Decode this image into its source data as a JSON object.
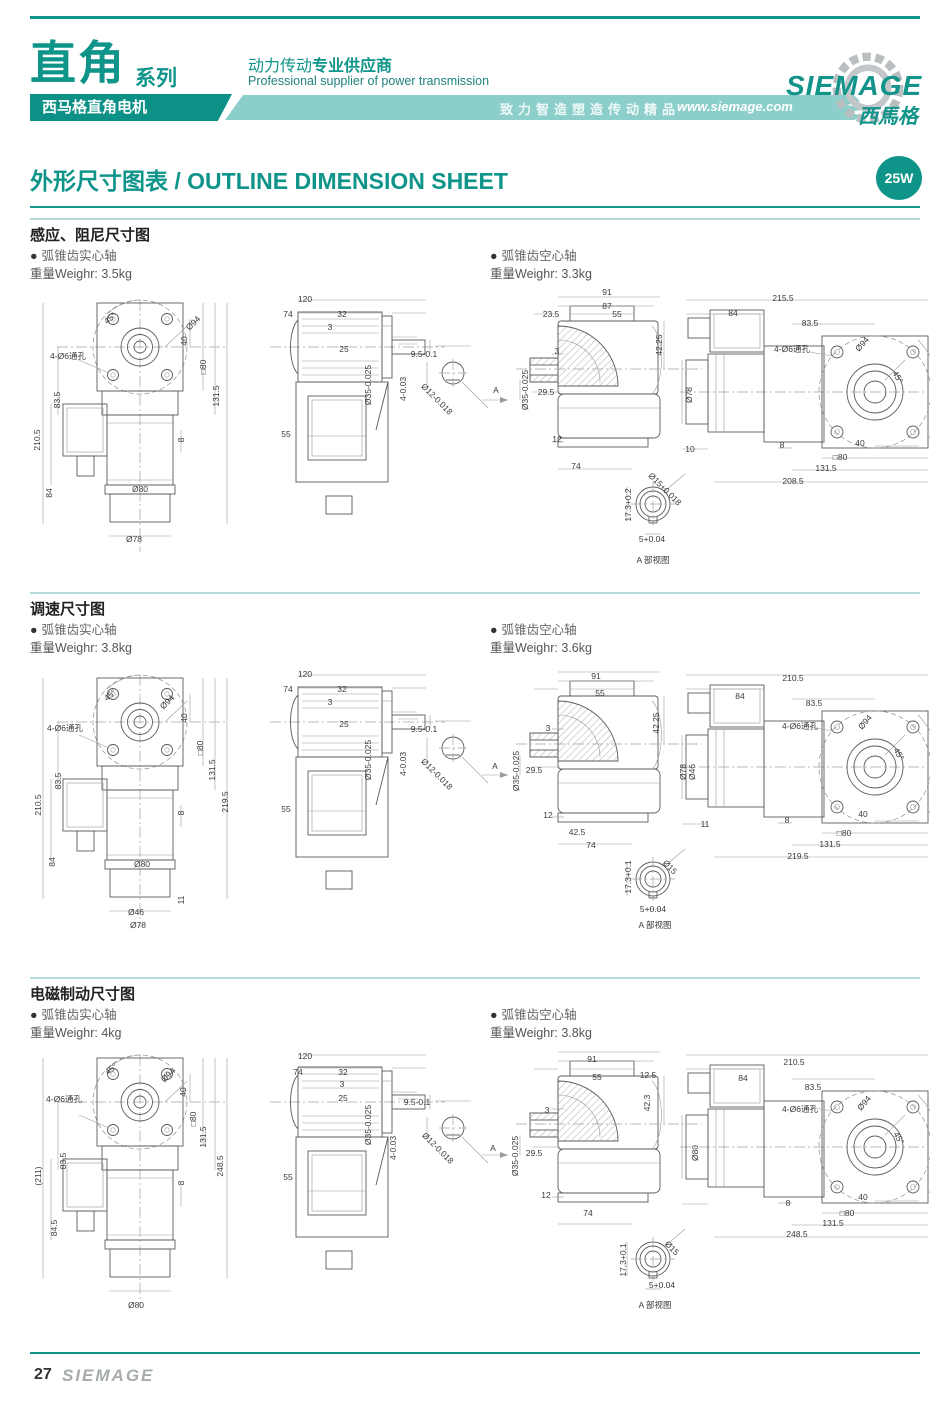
{
  "header": {
    "series_title": "直角",
    "series_suffix": "系列",
    "subtitle_box": "西马格直角电机",
    "slogan_cn_regular": "动力传动",
    "slogan_cn_bold": "专业供应商",
    "slogan_en": "Professional supplier of power transmission",
    "banner_text": "致力智造塑造传动精品",
    "website": "www.siemage.com",
    "logo_text": "SIEMAGE",
    "logo_cn": "西馬格",
    "accent_color": "#0f948a",
    "band_color": "#8ccfca"
  },
  "page_title": {
    "text": "外形尺寸图表 / OUTLINE DIMENSION SHEET",
    "badge": "25W"
  },
  "footer": {
    "page_number": "27",
    "logo": "SIEMAGE"
  },
  "sections": [
    {
      "title": "感应、阻尼尺寸图",
      "left_bullet": "弧锥齿实心轴",
      "left_weight": "重量Weighr: 3.5kg",
      "right_bullet": "弧锥齿空心轴",
      "right_weight": "重量Weighr: 3.3kg",
      "labels": [
        {
          "t": "45°",
          "x": 80,
          "y": 30,
          "r": -40
        },
        {
          "t": "Ø94",
          "x": 163,
          "y": 35,
          "r": -45
        },
        {
          "t": "4-Ø6通孔",
          "x": 38,
          "y": 68
        },
        {
          "t": "40",
          "x": 154,
          "y": 53,
          "r": -90
        },
        {
          "t": "□80",
          "x": 173,
          "y": 79,
          "r": -90
        },
        {
          "t": "131.5",
          "x": 186,
          "y": 108,
          "r": -90
        },
        {
          "t": "210.5",
          "x": 7,
          "y": 152,
          "r": -90
        },
        {
          "t": "83.5",
          "x": 27,
          "y": 112,
          "r": -90
        },
        {
          "t": "84",
          "x": 19,
          "y": 205,
          "r": -90
        },
        {
          "t": "8",
          "x": 151,
          "y": 152,
          "r": -90
        },
        {
          "t": "Ø80",
          "x": 110,
          "y": 201
        },
        {
          "t": "Ø78",
          "x": 104,
          "y": 251
        },
        {
          "t": "120",
          "x": 275,
          "y": 11
        },
        {
          "t": "74",
          "x": 258,
          "y": 26
        },
        {
          "t": "32",
          "x": 312,
          "y": 26
        },
        {
          "t": "3",
          "x": 300,
          "y": 39
        },
        {
          "t": "25",
          "x": 314,
          "y": 61
        },
        {
          "t": "Ø35-0.025",
          "x": 338,
          "y": 97,
          "r": -90
        },
        {
          "t": "55",
          "x": 256,
          "y": 146
        },
        {
          "t": "9.5-0.1",
          "x": 394,
          "y": 66
        },
        {
          "t": "4-0.03",
          "x": 373,
          "y": 101,
          "r": -90
        },
        {
          "t": "Ø12-0.018",
          "x": 407,
          "y": 111,
          "r": 45
        },
        {
          "t": "91",
          "x": 577,
          "y": 4
        },
        {
          "t": "87",
          "x": 577,
          "y": 18
        },
        {
          "t": "23.5",
          "x": 521,
          "y": 26
        },
        {
          "t": "55",
          "x": 587,
          "y": 26
        },
        {
          "t": "3",
          "x": 527,
          "y": 63
        },
        {
          "t": "42.25",
          "x": 629,
          "y": 57,
          "r": -90
        },
        {
          "t": "A",
          "x": 466,
          "y": 102
        },
        {
          "t": "29.5",
          "x": 516,
          "y": 104
        },
        {
          "t": "Ø35-0.025",
          "x": 495,
          "y": 102,
          "r": -90
        },
        {
          "t": "12",
          "x": 527,
          "y": 151
        },
        {
          "t": "74",
          "x": 546,
          "y": 178
        },
        {
          "t": "10",
          "x": 660,
          "y": 161
        },
        {
          "t": "Ø15+0.018",
          "x": 635,
          "y": 201,
          "r": 45
        },
        {
          "t": "17.3+0.2",
          "x": 598,
          "y": 217,
          "r": -90
        },
        {
          "t": "5+0.04",
          "x": 622,
          "y": 251
        },
        {
          "t": "A 部视图",
          "x": 623,
          "y": 272
        },
        {
          "t": "215.5",
          "x": 753,
          "y": 10
        },
        {
          "t": "84",
          "x": 703,
          "y": 25
        },
        {
          "t": "83.5",
          "x": 780,
          "y": 35
        },
        {
          "t": "4-Ø6通孔",
          "x": 762,
          "y": 61
        },
        {
          "t": "Ø94",
          "x": 832,
          "y": 56,
          "r": -50
        },
        {
          "t": "45°",
          "x": 868,
          "y": 89,
          "r": 60
        },
        {
          "t": "Ø78",
          "x": 659,
          "y": 107,
          "r": -90
        },
        {
          "t": "8",
          "x": 752,
          "y": 157
        },
        {
          "t": "40",
          "x": 830,
          "y": 155
        },
        {
          "t": "□80",
          "x": 810,
          "y": 169
        },
        {
          "t": "131.5",
          "x": 796,
          "y": 180
        },
        {
          "t": "208.5",
          "x": 763,
          "y": 193
        }
      ]
    },
    {
      "title": "调速尺寸图",
      "left_bullet": "弧锥齿实心轴",
      "left_weight": "重量Weighr: 3.8kg",
      "right_bullet": "弧锥齿空心轴",
      "right_weight": "重量Weighr: 3.6kg",
      "labels": [
        {
          "t": "45°",
          "x": 80,
          "y": 32,
          "r": -40
        },
        {
          "t": "Ø94",
          "x": 137,
          "y": 39,
          "r": -45
        },
        {
          "t": "4-Ø6通孔",
          "x": 35,
          "y": 65
        },
        {
          "t": "40",
          "x": 154,
          "y": 55,
          "r": -90
        },
        {
          "t": "□80",
          "x": 170,
          "y": 85,
          "r": -90
        },
        {
          "t": "131.5",
          "x": 182,
          "y": 107,
          "r": -90
        },
        {
          "t": "83.5",
          "x": 28,
          "y": 118,
          "r": -90
        },
        {
          "t": "210.5",
          "x": 8,
          "y": 142,
          "r": -90
        },
        {
          "t": "219.5",
          "x": 195,
          "y": 139,
          "r": -90
        },
        {
          "t": "8",
          "x": 151,
          "y": 150,
          "r": -90
        },
        {
          "t": "84",
          "x": 22,
          "y": 199,
          "r": -90
        },
        {
          "t": "Ø80",
          "x": 112,
          "y": 201
        },
        {
          "t": "11",
          "x": 151,
          "y": 237,
          "r": -90
        },
        {
          "t": "Ø46",
          "x": 106,
          "y": 249
        },
        {
          "t": "Ø78",
          "x": 108,
          "y": 262
        },
        {
          "t": "120",
          "x": 275,
          "y": 11
        },
        {
          "t": "74",
          "x": 258,
          "y": 26
        },
        {
          "t": "32",
          "x": 312,
          "y": 26
        },
        {
          "t": "3",
          "x": 300,
          "y": 39
        },
        {
          "t": "25",
          "x": 314,
          "y": 61
        },
        {
          "t": "Ø35-0.025",
          "x": 338,
          "y": 97,
          "r": -90
        },
        {
          "t": "55",
          "x": 256,
          "y": 146
        },
        {
          "t": "9.5-0.1",
          "x": 394,
          "y": 66
        },
        {
          "t": "4-0.03",
          "x": 373,
          "y": 101,
          "r": -90
        },
        {
          "t": "Ø12-0.018",
          "x": 407,
          "y": 111,
          "r": 45
        },
        {
          "t": "91",
          "x": 566,
          "y": 13
        },
        {
          "t": "55",
          "x": 570,
          "y": 30
        },
        {
          "t": "3",
          "x": 518,
          "y": 65
        },
        {
          "t": "42.25",
          "x": 626,
          "y": 60,
          "r": -90
        },
        {
          "t": "A",
          "x": 465,
          "y": 103
        },
        {
          "t": "29.5",
          "x": 504,
          "y": 107
        },
        {
          "t": "Ø35-0.025",
          "x": 486,
          "y": 108,
          "r": -90
        },
        {
          "t": "12",
          "x": 518,
          "y": 152
        },
        {
          "t": "42.5",
          "x": 547,
          "y": 169
        },
        {
          "t": "74",
          "x": 561,
          "y": 182
        },
        {
          "t": "Ø78",
          "x": 653,
          "y": 109,
          "r": -90
        },
        {
          "t": "Ø46",
          "x": 662,
          "y": 109,
          "r": -90
        },
        {
          "t": "11",
          "x": 675,
          "y": 161
        },
        {
          "t": "17.3+0.1",
          "x": 598,
          "y": 214,
          "r": -90
        },
        {
          "t": "Ø15",
          "x": 640,
          "y": 204,
          "r": 45
        },
        {
          "t": "5+0.04",
          "x": 623,
          "y": 246
        },
        {
          "t": "A 部视图",
          "x": 625,
          "y": 262
        },
        {
          "t": "210.5",
          "x": 763,
          "y": 15
        },
        {
          "t": "84",
          "x": 710,
          "y": 33
        },
        {
          "t": "83.5",
          "x": 784,
          "y": 40
        },
        {
          "t": "4-Ø6通孔",
          "x": 770,
          "y": 63
        },
        {
          "t": "Ø94",
          "x": 835,
          "y": 59,
          "r": -50
        },
        {
          "t": "45°",
          "x": 869,
          "y": 91,
          "r": 60
        },
        {
          "t": "8",
          "x": 757,
          "y": 157
        },
        {
          "t": "40",
          "x": 833,
          "y": 151
        },
        {
          "t": "□80",
          "x": 814,
          "y": 170
        },
        {
          "t": "131.5",
          "x": 800,
          "y": 181
        },
        {
          "t": "219.5",
          "x": 768,
          "y": 193
        }
      ]
    },
    {
      "title": "电磁制动尺寸图",
      "left_bullet": "弧锥齿实心轴",
      "left_weight": "重量Weighr: 4kg",
      "right_bullet": "弧锥齿空心轴",
      "right_weight": "重量Weighr: 3.8kg",
      "labels": [
        {
          "t": "45°",
          "x": 81,
          "y": 26,
          "r": -40
        },
        {
          "t": "Ø94",
          "x": 138,
          "y": 32,
          "r": -45
        },
        {
          "t": "4-Ø6通孔",
          "x": 34,
          "y": 56
        },
        {
          "t": "40",
          "x": 153,
          "y": 49,
          "r": -90
        },
        {
          "t": "□80",
          "x": 163,
          "y": 76,
          "r": -90
        },
        {
          "t": "131.5",
          "x": 173,
          "y": 94,
          "r": -90
        },
        {
          "t": "83.5",
          "x": 33,
          "y": 118,
          "r": -90
        },
        {
          "t": "(211)",
          "x": 8,
          "y": 133,
          "r": -90
        },
        {
          "t": "248.5",
          "x": 190,
          "y": 123,
          "r": -90
        },
        {
          "t": "8",
          "x": 151,
          "y": 140,
          "r": -90
        },
        {
          "t": "84.5",
          "x": 24,
          "y": 185,
          "r": -90
        },
        {
          "t": "Ø80",
          "x": 106,
          "y": 262
        },
        {
          "t": "120",
          "x": 275,
          "y": 13
        },
        {
          "t": "74",
          "x": 268,
          "y": 29
        },
        {
          "t": "32",
          "x": 313,
          "y": 29
        },
        {
          "t": "3",
          "x": 312,
          "y": 41
        },
        {
          "t": "25",
          "x": 313,
          "y": 55
        },
        {
          "t": "Ø35-0.025",
          "x": 338,
          "y": 82,
          "r": -90
        },
        {
          "t": "55",
          "x": 258,
          "y": 134
        },
        {
          "t": "9.5-0.1",
          "x": 387,
          "y": 59
        },
        {
          "t": "4-0.03",
          "x": 363,
          "y": 105,
          "r": -90
        },
        {
          "t": "Ø12-0.018",
          "x": 408,
          "y": 105,
          "r": 45
        },
        {
          "t": "91",
          "x": 562,
          "y": 16
        },
        {
          "t": "55",
          "x": 567,
          "y": 34
        },
        {
          "t": "12.5",
          "x": 618,
          "y": 32
        },
        {
          "t": "3",
          "x": 517,
          "y": 67
        },
        {
          "t": "42.3",
          "x": 617,
          "y": 60,
          "r": -90
        },
        {
          "t": "A",
          "x": 463,
          "y": 105
        },
        {
          "t": "29.5",
          "x": 504,
          "y": 110
        },
        {
          "t": "Ø35-0.025",
          "x": 485,
          "y": 113,
          "r": -90
        },
        {
          "t": "12",
          "x": 516,
          "y": 152
        },
        {
          "t": "74",
          "x": 558,
          "y": 170
        },
        {
          "t": "Ø80",
          "x": 665,
          "y": 110,
          "r": -90
        },
        {
          "t": "17.3+0.1",
          "x": 593,
          "y": 217,
          "r": -90
        },
        {
          "t": "Ø15",
          "x": 642,
          "y": 205,
          "r": 45
        },
        {
          "t": "5+0.04",
          "x": 632,
          "y": 242
        },
        {
          "t": "A 部视图",
          "x": 625,
          "y": 262
        },
        {
          "t": "210.5",
          "x": 764,
          "y": 19
        },
        {
          "t": "84",
          "x": 713,
          "y": 35
        },
        {
          "t": "83.5",
          "x": 783,
          "y": 44
        },
        {
          "t": "4-Ø6通孔",
          "x": 770,
          "y": 66
        },
        {
          "t": "Ø94",
          "x": 834,
          "y": 60,
          "r": -50
        },
        {
          "t": "45°",
          "x": 869,
          "y": 95,
          "r": 60
        },
        {
          "t": "8",
          "x": 758,
          "y": 160
        },
        {
          "t": "40",
          "x": 833,
          "y": 154
        },
        {
          "t": "□80",
          "x": 817,
          "y": 170
        },
        {
          "t": "131.5",
          "x": 803,
          "y": 180
        },
        {
          "t": "248.5",
          "x": 767,
          "y": 191
        }
      ]
    }
  ]
}
